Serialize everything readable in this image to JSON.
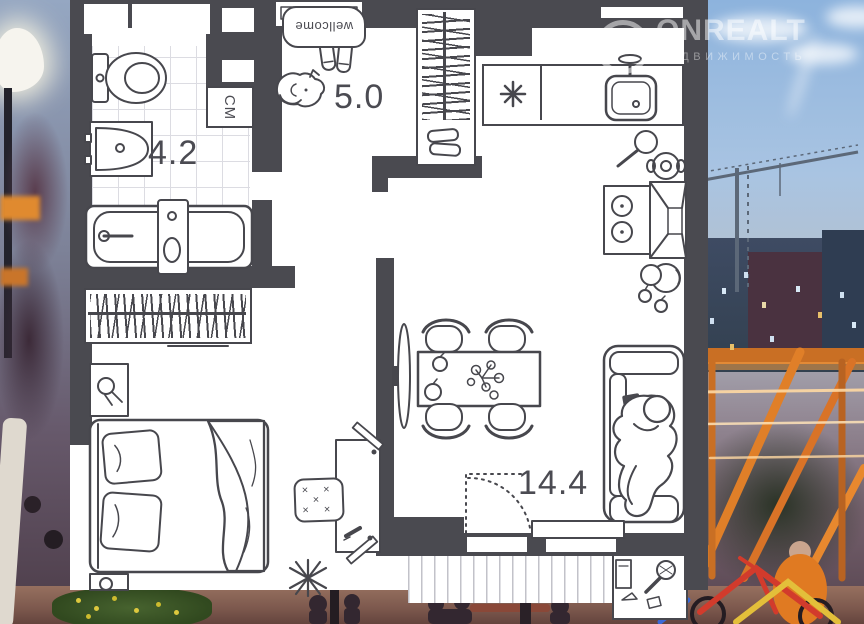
{
  "watermark": {
    "brand": "ONREALT",
    "subtitle": "НЕДВИЖИМОСТЬ",
    "logo_glyph": "⌂"
  },
  "floorplan": {
    "rooms": [
      {
        "id": "bathroom",
        "area": "4.2"
      },
      {
        "id": "hallway",
        "area": "5.0"
      },
      {
        "id": "living-room",
        "area": "14.4"
      }
    ],
    "labels": {
      "washing_machine": "СМ",
      "doormat": "wellcome"
    },
    "symbols": {
      "kitchen_star": "✳",
      "plant": "✻",
      "pouf_row1": "× ×",
      "pouf_row2": "×",
      "pouf_row3": "× ×"
    },
    "colors": {
      "wall": "#4a4a50",
      "line": "#47474d",
      "floor": "#ffffff",
      "tile_line": "#dcdce2"
    }
  },
  "background": {
    "colors": {
      "sky": "#8db3dd",
      "pergola_wood": "#e07f28",
      "light_string": "#ffd9a3",
      "bike_red": "#d23b2c",
      "bike_yellow": "#e3bf3a",
      "foliage": "#3c2a38"
    }
  }
}
